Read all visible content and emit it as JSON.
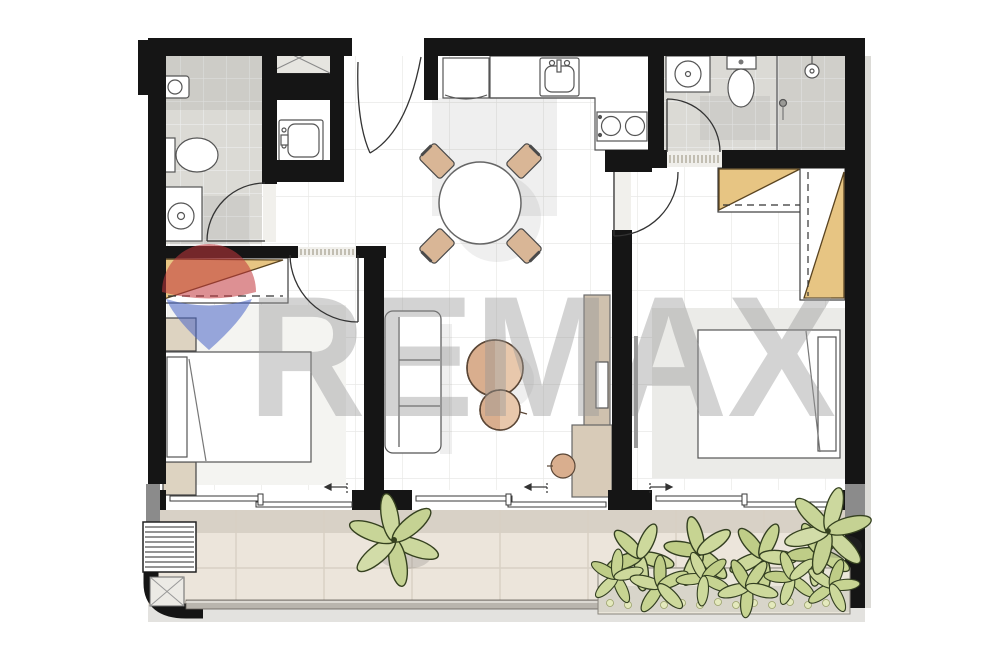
{
  "watermark": {
    "text": "REMAX",
    "text_color": "#979797",
    "balloon_top_color": "#c2363c",
    "balloon_bottom_color": "#4a66c8"
  },
  "palette": {
    "wall": "#151515",
    "wall_gray_segment": "#8b8b8b",
    "floor_white": "#ffffff",
    "tile_line": "#e9e9e7",
    "bathroom_floor": "#dbdad5",
    "wood_wardrobe": "#e7c583",
    "furniture_tan": "#d9ae8e",
    "furniture_tan_light": "#eacdb2",
    "nightstand_beige": "#ddd3c1",
    "console_taupe": "#cfc1ae",
    "balcony_floor": "#ece5db",
    "balcony_strip": "#d8d1c6",
    "rug": "#ebebe8",
    "plant_green": "#ccd89e",
    "plant_outline": "#35411f",
    "shrub_green": "#c7d492",
    "railing": "#b9b5ae",
    "outline": "#555555"
  }
}
